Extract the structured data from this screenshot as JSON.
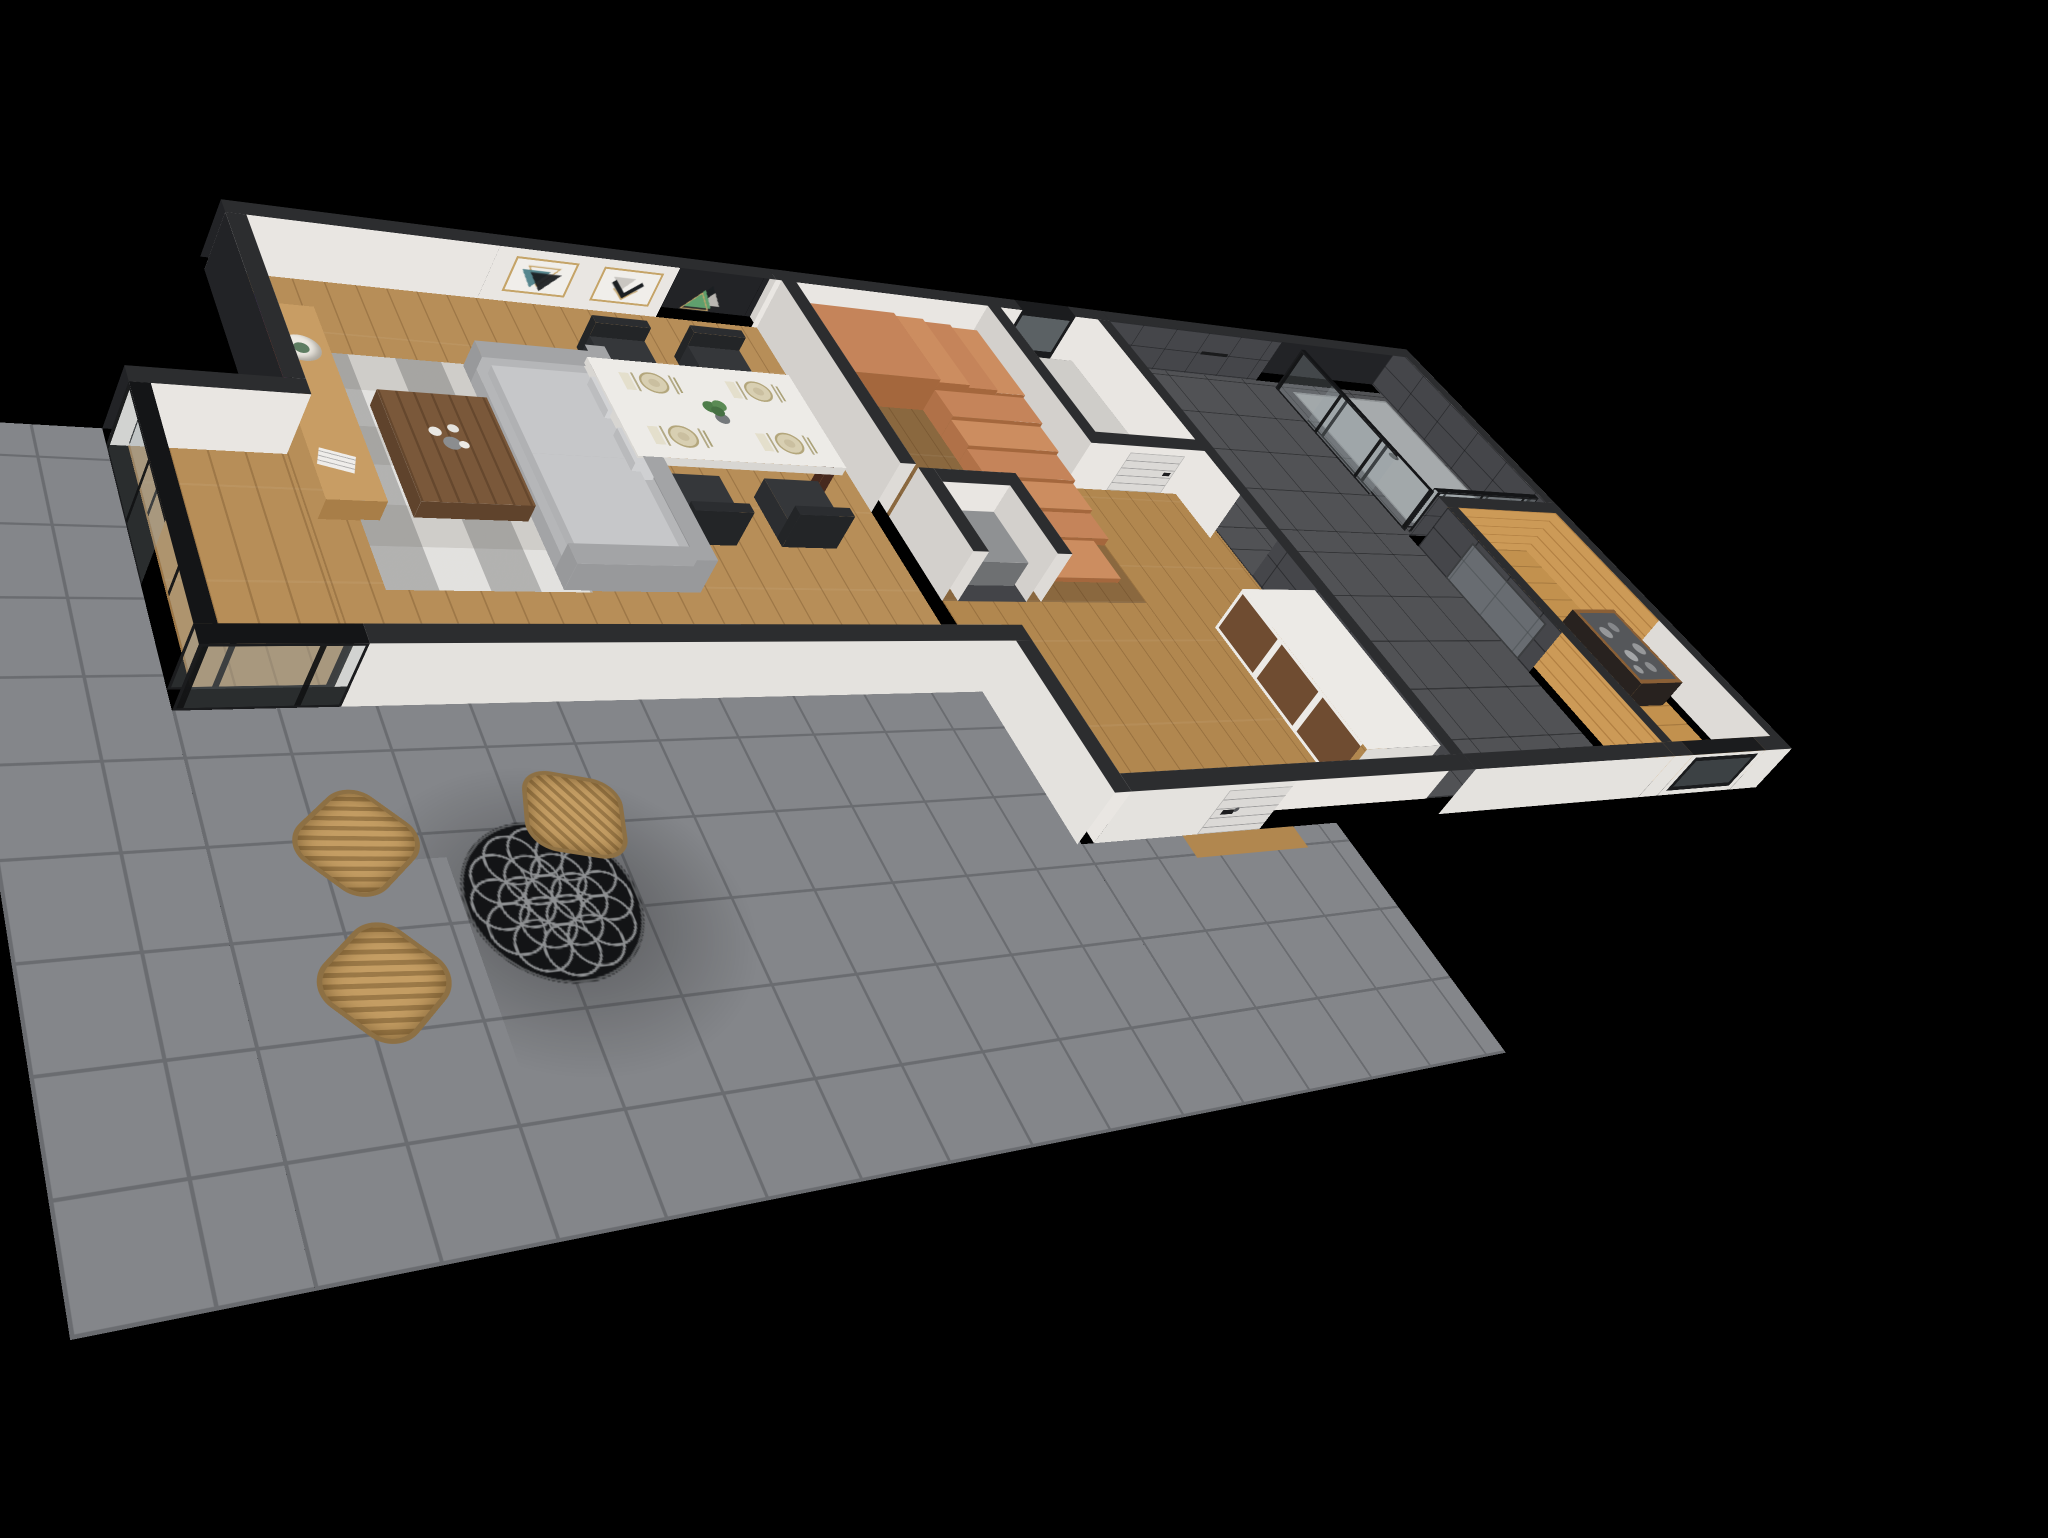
{
  "meta": {
    "type": "3d-floor-plan-render",
    "projection": "isometric-dollhouse-perspective",
    "background": "#000000"
  },
  "palette": {
    "wallTop": "#2c2d2f",
    "wallExtDark": "#222326",
    "wallWhite": "#e9e6e2",
    "wallShadedE": "#dedbd7",
    "wallShadedW": "#d3d0cc",
    "wallExtLight": "#e4e2de",
    "wood": "#b78e58",
    "woodHall": "#b1874f",
    "woodDark": "#8a683f",
    "plankLine": "rgba(70,40,12,0.22)",
    "stairTop": "#c5845a",
    "stairAlt": "#cc8d60",
    "stairRiser": "#a4673d",
    "stairSide": "#b07148",
    "bathFloor": "#515255",
    "bathWall": "#45464a",
    "showerTray": "#a6aaac",
    "drain": "#3a3b3d",
    "glass": "rgba(150,160,166,0.28)",
    "glassFrame": "#1b1c1e",
    "glassTop": "#141517",
    "saunaFloor": "#c2914e",
    "saunaWall": "#cc9a57",
    "terraceTile": "#84868a",
    "terraceLine": "#6a6c70",
    "sofaBase": "#b5b6b8",
    "sofaCushion": "#c6c7c9",
    "sofaDark": "#a3a4a6",
    "rug": "#cfcdc9",
    "rugDark": "#97948f",
    "coffeeTable": "#7a583a",
    "console": "#c89d64",
    "consoleSide": "#a87e48",
    "tableTop": "#edebe7",
    "tableLeg": "#46291e",
    "chair": "#35373a",
    "chairDark": "#2b2d30",
    "plate": "#d8cfb2",
    "plateRim": "#b3a67c",
    "napkin": "#e4dfcc",
    "plant": "#4e7d4a",
    "pot": "#75797c",
    "lampShade": "#edeae3",
    "lampBase": "#5e7d62",
    "tvFrame": "#0b0d11",
    "nebulaDeep": "#1e2a6a",
    "nebulaPurple": "#6a3d99",
    "nebulaRed": "#c2503c",
    "nebulaOrange": "#e09a42",
    "artGold": "#c5a468",
    "artTeal": "#497d86",
    "artBlack": "#1b1f22",
    "artGray": "#c9c6c1",
    "artGreen": "#5f9f6d",
    "door": "#dbd9d6",
    "handle": "#1d1d1f",
    "wardrobeWood": "#6f4c31",
    "counter": "#8f9193",
    "nicheFloor": "#434448",
    "heaterFrame": "#28221f",
    "heaterStone": "#96989a",
    "heaterRail": "#8a5f36",
    "rattan": "#c49d63",
    "patioTable": "#131416",
    "patioPattern": "#8e9092",
    "wcFloor": "#cfcdc9"
  },
  "scene": {
    "rooms": [
      {
        "name": "living-room",
        "floor": "wood planks",
        "features": [
          "wall-mounted tv with galaxy image",
          "wood tv console",
          "table lamp with green base",
          "magazine",
          "gray corner sofa with pillows",
          "walnut coffee table with white flowers",
          "patchwork gray rug",
          "floor-to-ceiling glass wall with black mullions"
        ]
      },
      {
        "name": "dining-area",
        "floor": "wood planks",
        "art_frames": [
          {
            "design": "overlapping down-pointing triangles",
            "colors": [
              "gold outline",
              "teal",
              "black"
            ]
          },
          {
            "design": "chevron V shapes",
            "colors": [
              "gray",
              "black",
              "gold outline"
            ]
          },
          {
            "design": "overlapping up-pointing triangles",
            "colors": [
              "black",
              "gray",
              "green",
              "gold outline"
            ]
          }
        ],
        "table": {
          "shape": "rectangular",
          "top": "white",
          "legs": "dark wood",
          "place_settings": 4,
          "centerpiece": "potted green plant"
        },
        "chairs": {
          "count": 4,
          "style": "black shell with wood legs"
        }
      },
      {
        "name": "staircase-hall",
        "floor": "dark wood planks",
        "staircase": {
          "type": "quarter-turn winder",
          "material": "terracotta",
          "visible_steps": 10
        }
      },
      {
        "name": "hallway",
        "floor": "wood planks",
        "furniture": [
          "low wardrobe with walnut panels and white trim"
        ],
        "entrance_door": {
          "color": "white",
          "style": "horizontal grooves",
          "handle": "black"
        }
      },
      {
        "name": "wc-closet",
        "floor": "light screed",
        "window": {
          "frame": "black",
          "position": "top wall"
        }
      },
      {
        "name": "bathroom",
        "floor": "dark gray tile",
        "walls": "dark gray tile",
        "shower": {
          "enclosure": "glass with black trim",
          "tray": "light gray",
          "fixtures": "black"
        },
        "door": {
          "color": "white",
          "handle": "black"
        }
      },
      {
        "name": "sauna",
        "floor": "wood planks",
        "walls": "wood planks",
        "heater": {
          "frame": "dark metal",
          "stones": "gray",
          "guard_rail": "wood"
        },
        "door": "glass with black handle",
        "window": {
          "frame": "black",
          "position": "bottom wall"
        }
      },
      {
        "name": "terrace",
        "floor": "gray concrete tiles",
        "table": {
          "shape": "round",
          "color": "black",
          "pattern": "flower-of-life lattice"
        },
        "chairs": {
          "count": 3,
          "material": "woven rattan"
        }
      }
    ]
  }
}
